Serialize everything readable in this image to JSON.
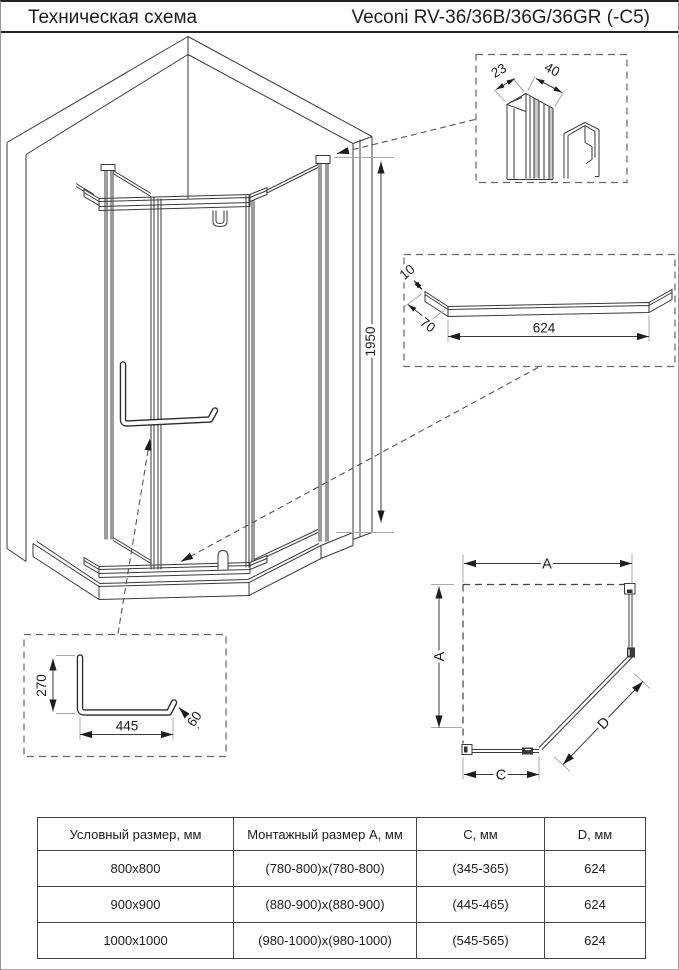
{
  "header": {
    "title_left": "Техническая схема",
    "title_right": "Veconi RV-36/36B/36G/36GR (-C5)"
  },
  "drawing": {
    "height_dim": "1950",
    "profile_detail": {
      "width_small": "23",
      "width_large": "40"
    },
    "bar_detail": {
      "thickness": "10",
      "end_segment": "70",
      "length": "624"
    },
    "handle_detail": {
      "vertical": "270",
      "horizontal": "445",
      "end": "60"
    },
    "plan": {
      "dim_top": "A",
      "dim_left": "A",
      "dim_bottom": "C",
      "dim_diagonal": "D"
    }
  },
  "table": {
    "headers": [
      "Условный размер, мм",
      "Монтажный размер А, мм",
      "С, мм",
      "D, мм"
    ],
    "rows": [
      [
        "800x800",
        "(780-800)x(780-800)",
        "(345-365)",
        "624"
      ],
      [
        "900x900",
        "(880-900)x(880-900)",
        "(445-465)",
        "624"
      ],
      [
        "1000x1000",
        "(980-1000)x(980-1000)",
        "(545-565)",
        "624"
      ]
    ]
  }
}
